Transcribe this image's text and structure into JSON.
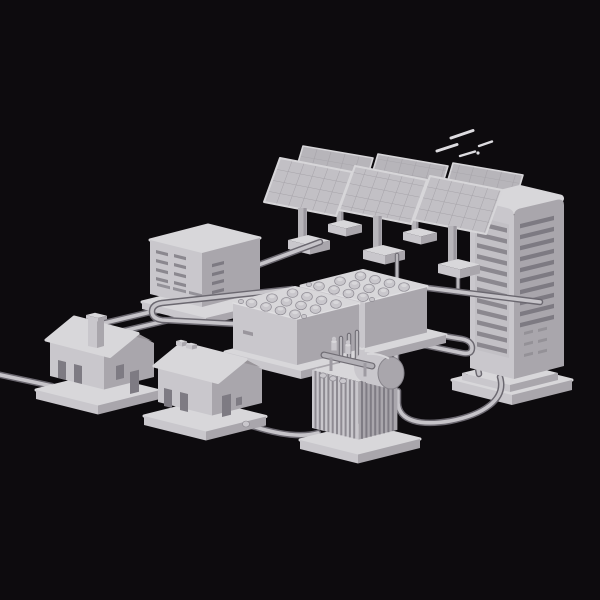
{
  "scene": {
    "description": "Isometric 3D render of an off-grid solar power microgrid on a black background: solar panel array feeding an inverter cabinet, battery bank and distribution transformer that connect two houses and a high-rise building with conduit pipes",
    "background": "#0d0b0e",
    "palette": {
      "bg": "#0d0b0e",
      "top": "#d8d7da",
      "light": "#c9c7cc",
      "mid": "#a9a6ac",
      "dark": "#989499",
      "slat": "#8b888f",
      "slat-dark": "#7d7a82",
      "glass": "#c2c0c5",
      "glass-back": "#b7b5ba",
      "gridline": "#a5a2a8",
      "frame": "#d7d6d9",
      "pipe": "#c6c4c9",
      "pipe-edge": "#6b6870",
      "rod": "#b9b7bc",
      "win": "#7e7b83",
      "spark": "#dddce0",
      "pole": "#b7b5ba"
    },
    "components": [
      {
        "id": "spark-marks",
        "label": "energy spark marks",
        "count": 5
      },
      {
        "id": "solar-array",
        "label": "solar panel array",
        "panels": 6,
        "rows": 2
      },
      {
        "id": "office-tower",
        "label": "high-rise building with louvered facade"
      },
      {
        "id": "inverter-cabinet",
        "label": "inverter cabinet on concrete pad"
      },
      {
        "id": "battery-bank",
        "label": "battery bank",
        "batteries": 2,
        "caps_per_battery": 12
      },
      {
        "id": "house-1",
        "label": "small house with chimney"
      },
      {
        "id": "house-2",
        "label": "small house with roof vents"
      },
      {
        "id": "transformer",
        "label": "distribution transformer with cooling fins and conservator tank"
      },
      {
        "id": "cable-network",
        "label": "connecting conduit pipes and cables"
      }
    ]
  }
}
